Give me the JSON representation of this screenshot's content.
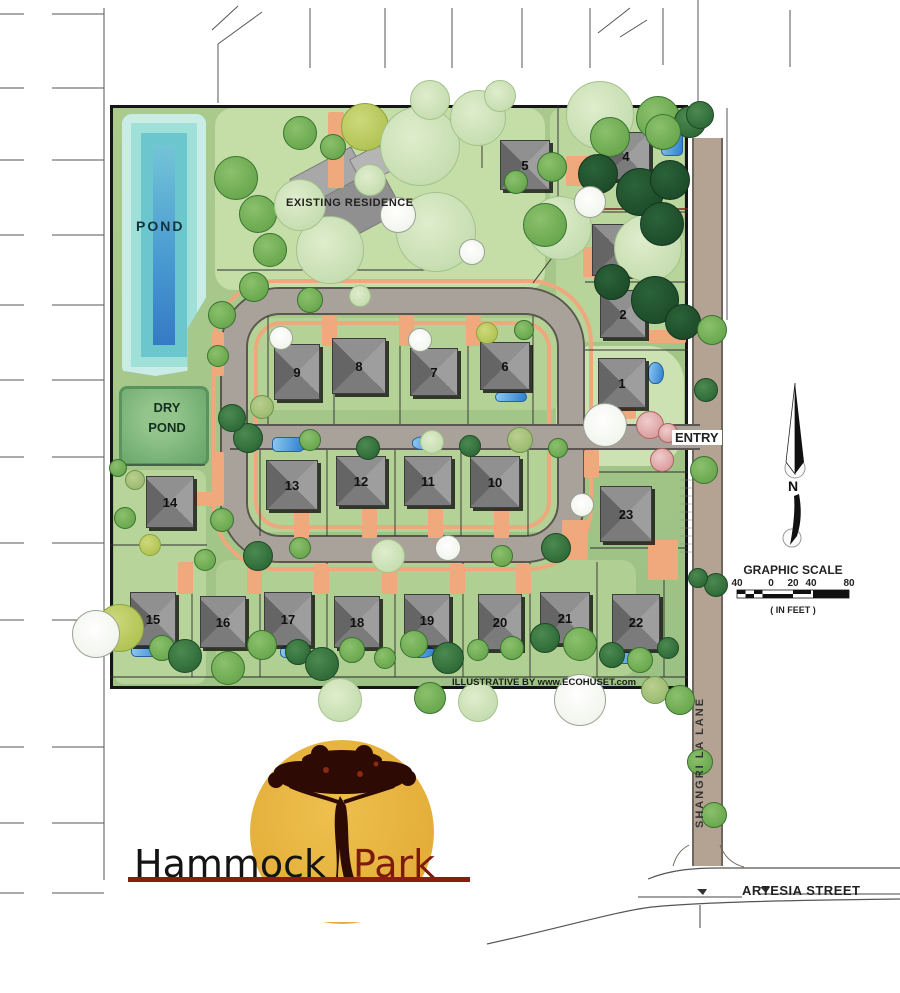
{
  "page_title": "Hammock Park Site Plan",
  "labels": {
    "pond": "POND",
    "dry_pond": "DRY POND",
    "existing_residence": "EXISTING RESIDENCE",
    "entry": "ENTRY",
    "north": "N",
    "graphic_scale": "GRAPHIC SCALE",
    "in_feet": "( IN FEET )",
    "shangri_la_lane": "SHANGRI LA LANE",
    "artesia_street": "ARTESIA STREET",
    "credit": "ILLUSTRATIVE BY www.ECOHUSET.com"
  },
  "scale_ticks": [
    "40",
    "0",
    "20",
    "40",
    "80"
  ],
  "logo": {
    "word1": "Hammock",
    "word2": "Park"
  },
  "colors": {
    "site_green": "#a6c989",
    "road_gray": "#a9a29a",
    "road_edge": "#5b5750",
    "driveway_peach": "#f0a97c",
    "lane_tan": "#b4a393",
    "pond_blue": "#2d6fbe",
    "pond_teal": "#7fd0d8",
    "dry_pond_green": "#6aa86c",
    "house_gray": "#8f8f8f",
    "logo_gold": "#e2ab35",
    "logo_red": "#8c1b10",
    "tree_palette": [
      "#6aa84f",
      "#2f6b38",
      "#1d4c2a",
      "#b2c455",
      "#c4dcae",
      "#9dbb72",
      "#f6f8f2",
      "#db9f9f"
    ]
  },
  "lots": [
    {
      "n": "1",
      "x": 598,
      "y": 358,
      "w": 48,
      "h": 50
    },
    {
      "n": "2",
      "x": 600,
      "y": 290,
      "w": 46,
      "h": 48
    },
    {
      "n": "3",
      "x": 592,
      "y": 224,
      "w": 54,
      "h": 52
    },
    {
      "n": "4",
      "x": 602,
      "y": 132,
      "w": 48,
      "h": 48
    },
    {
      "n": "5",
      "x": 500,
      "y": 140,
      "w": 50,
      "h": 50
    },
    {
      "n": "6",
      "x": 480,
      "y": 342,
      "w": 50,
      "h": 48
    },
    {
      "n": "7",
      "x": 410,
      "y": 348,
      "w": 48,
      "h": 48
    },
    {
      "n": "8",
      "x": 332,
      "y": 338,
      "w": 54,
      "h": 56
    },
    {
      "n": "9",
      "x": 274,
      "y": 344,
      "w": 46,
      "h": 56
    },
    {
      "n": "10",
      "x": 470,
      "y": 456,
      "w": 50,
      "h": 52
    },
    {
      "n": "11",
      "x": 404,
      "y": 456,
      "w": 48,
      "h": 50
    },
    {
      "n": "12",
      "x": 336,
      "y": 456,
      "w": 50,
      "h": 50
    },
    {
      "n": "13",
      "x": 266,
      "y": 460,
      "w": 52,
      "h": 50
    },
    {
      "n": "14",
      "x": 146,
      "y": 476,
      "w": 48,
      "h": 52
    },
    {
      "n": "15",
      "x": 130,
      "y": 592,
      "w": 46,
      "h": 54
    },
    {
      "n": "16",
      "x": 200,
      "y": 596,
      "w": 46,
      "h": 52
    },
    {
      "n": "17",
      "x": 264,
      "y": 592,
      "w": 48,
      "h": 54
    },
    {
      "n": "18",
      "x": 334,
      "y": 596,
      "w": 46,
      "h": 52
    },
    {
      "n": "19",
      "x": 404,
      "y": 594,
      "w": 46,
      "h": 52
    },
    {
      "n": "20",
      "x": 478,
      "y": 594,
      "w": 44,
      "h": 56
    },
    {
      "n": "21",
      "x": 540,
      "y": 592,
      "w": 50,
      "h": 52
    },
    {
      "n": "22",
      "x": 612,
      "y": 594,
      "w": 48,
      "h": 56
    },
    {
      "n": "23",
      "x": 600,
      "y": 486,
      "w": 52,
      "h": 56
    }
  ],
  "patches": [
    {
      "x": 215,
      "y": 108,
      "w": 330,
      "h": 182,
      "c": "#c5dda7",
      "r": 18
    },
    {
      "x": 550,
      "y": 108,
      "w": 134,
      "h": 118,
      "c": "#bcd79d",
      "r": 12
    },
    {
      "x": 556,
      "y": 228,
      "w": 128,
      "h": 114,
      "c": "#b7d49a",
      "r": 12
    },
    {
      "x": 556,
      "y": 346,
      "w": 128,
      "h": 120,
      "c": "#cde2b2",
      "r": 36
    },
    {
      "x": 114,
      "y": 470,
      "w": 92,
      "h": 214,
      "c": "#b7d49a",
      "r": 10
    },
    {
      "x": 216,
      "y": 560,
      "w": 420,
      "h": 116,
      "c": "#b0cf92",
      "r": 14
    },
    {
      "x": 240,
      "y": 318,
      "w": 320,
      "h": 92,
      "c": "#b4d295",
      "r": 12
    },
    {
      "x": 240,
      "y": 448,
      "w": 320,
      "h": 84,
      "c": "#b4d295",
      "r": 12
    }
  ],
  "driveways": [
    {
      "x": 322,
      "y": 316,
      "w": 15,
      "h": 30
    },
    {
      "x": 399,
      "y": 316,
      "w": 15,
      "h": 30
    },
    {
      "x": 466,
      "y": 316,
      "w": 15,
      "h": 30
    },
    {
      "x": 294,
      "y": 508,
      "w": 15,
      "h": 30
    },
    {
      "x": 362,
      "y": 508,
      "w": 15,
      "h": 30
    },
    {
      "x": 428,
      "y": 508,
      "w": 15,
      "h": 30
    },
    {
      "x": 494,
      "y": 508,
      "w": 15,
      "h": 30
    },
    {
      "x": 178,
      "y": 562,
      "w": 15,
      "h": 32
    },
    {
      "x": 247,
      "y": 562,
      "w": 15,
      "h": 32
    },
    {
      "x": 314,
      "y": 564,
      "w": 15,
      "h": 30
    },
    {
      "x": 382,
      "y": 564,
      "w": 15,
      "h": 30
    },
    {
      "x": 450,
      "y": 564,
      "w": 15,
      "h": 30
    },
    {
      "x": 516,
      "y": 564,
      "w": 15,
      "h": 30
    },
    {
      "x": 584,
      "y": 450,
      "w": 15,
      "h": 28
    },
    {
      "x": 648,
      "y": 540,
      "w": 30,
      "h": 40
    },
    {
      "x": 562,
      "y": 520,
      "w": 26,
      "h": 40
    },
    {
      "x": 610,
      "y": 405,
      "w": 26,
      "h": 14
    },
    {
      "x": 328,
      "y": 112,
      "w": 16,
      "h": 76
    },
    {
      "x": 566,
      "y": 156,
      "w": 36,
      "h": 30
    },
    {
      "x": 583,
      "y": 247,
      "w": 26,
      "h": 30
    },
    {
      "x": 648,
      "y": 330,
      "w": 38,
      "h": 13
    },
    {
      "x": 212,
      "y": 332,
      "w": 12,
      "h": 44
    },
    {
      "x": 212,
      "y": 452,
      "w": 12,
      "h": 48
    },
    {
      "x": 194,
      "y": 492,
      "w": 30,
      "h": 14
    }
  ],
  "pools": [
    {
      "x": 272,
      "y": 437,
      "w": 32,
      "h": 15,
      "k": 0
    },
    {
      "x": 412,
      "y": 436,
      "w": 30,
      "h": 14,
      "k": 1
    },
    {
      "x": 661,
      "y": 124,
      "w": 22,
      "h": 32,
      "k": 0
    },
    {
      "x": 661,
      "y": 222,
      "w": 16,
      "h": 36,
      "k": 0
    },
    {
      "x": 648,
      "y": 362,
      "w": 16,
      "h": 22,
      "k": 1
    },
    {
      "x": 495,
      "y": 392,
      "w": 32,
      "h": 10,
      "k": 0
    },
    {
      "x": 131,
      "y": 644,
      "w": 34,
      "h": 13,
      "k": 0
    },
    {
      "x": 280,
      "y": 646,
      "w": 27,
      "h": 12,
      "k": 0
    },
    {
      "x": 408,
      "y": 645,
      "w": 27,
      "h": 13,
      "k": 1
    },
    {
      "x": 614,
      "y": 652,
      "w": 30,
      "h": 12,
      "k": 0
    }
  ],
  "trees": [
    {
      "x": 236,
      "y": 178,
      "r": 22,
      "c": 0
    },
    {
      "x": 258,
      "y": 214,
      "r": 19,
      "c": 0
    },
    {
      "x": 270,
      "y": 250,
      "r": 17,
      "c": 0
    },
    {
      "x": 254,
      "y": 287,
      "r": 15,
      "c": 0
    },
    {
      "x": 300,
      "y": 133,
      "r": 17,
      "c": 0
    },
    {
      "x": 333,
      "y": 147,
      "r": 13,
      "c": 0
    },
    {
      "x": 365,
      "y": 127,
      "r": 24,
      "c": 3
    },
    {
      "x": 420,
      "y": 146,
      "r": 40,
      "c": 4
    },
    {
      "x": 478,
      "y": 118,
      "r": 28,
      "c": 4
    },
    {
      "x": 330,
      "y": 250,
      "r": 34,
      "c": 4
    },
    {
      "x": 436,
      "y": 232,
      "r": 40,
      "c": 4
    },
    {
      "x": 300,
      "y": 205,
      "r": 26,
      "c": 4
    },
    {
      "x": 560,
      "y": 228,
      "r": 32,
      "c": 4
    },
    {
      "x": 648,
      "y": 248,
      "r": 34,
      "c": 4
    },
    {
      "x": 600,
      "y": 115,
      "r": 34,
      "c": 4
    },
    {
      "x": 610,
      "y": 137,
      "r": 20,
      "c": 0
    },
    {
      "x": 658,
      "y": 118,
      "r": 22,
      "c": 0
    },
    {
      "x": 690,
      "y": 122,
      "r": 16,
      "c": 1
    },
    {
      "x": 552,
      "y": 167,
      "r": 15,
      "c": 0
    },
    {
      "x": 545,
      "y": 225,
      "r": 22,
      "c": 0
    },
    {
      "x": 598,
      "y": 174,
      "r": 20,
      "c": 2
    },
    {
      "x": 640,
      "y": 192,
      "r": 24,
      "c": 2
    },
    {
      "x": 670,
      "y": 180,
      "r": 20,
      "c": 2
    },
    {
      "x": 662,
      "y": 224,
      "r": 22,
      "c": 2
    },
    {
      "x": 612,
      "y": 282,
      "r": 18,
      "c": 2
    },
    {
      "x": 655,
      "y": 300,
      "r": 24,
      "c": 2
    },
    {
      "x": 683,
      "y": 322,
      "r": 18,
      "c": 2
    },
    {
      "x": 590,
      "y": 202,
      "r": 16,
      "c": 6
    },
    {
      "x": 398,
      "y": 215,
      "r": 18,
      "c": 6
    },
    {
      "x": 472,
      "y": 252,
      "r": 13,
      "c": 6
    },
    {
      "x": 516,
      "y": 182,
      "r": 12,
      "c": 0
    },
    {
      "x": 430,
      "y": 100,
      "r": 20,
      "c": 4
    },
    {
      "x": 500,
      "y": 96,
      "r": 16,
      "c": 4
    },
    {
      "x": 370,
      "y": 180,
      "r": 16,
      "c": 4
    },
    {
      "x": 281,
      "y": 338,
      "r": 12,
      "c": 6
    },
    {
      "x": 420,
      "y": 340,
      "r": 12,
      "c": 6
    },
    {
      "x": 487,
      "y": 333,
      "r": 11,
      "c": 3
    },
    {
      "x": 524,
      "y": 330,
      "r": 10,
      "c": 0
    },
    {
      "x": 310,
      "y": 300,
      "r": 13,
      "c": 0
    },
    {
      "x": 360,
      "y": 296,
      "r": 11,
      "c": 4
    },
    {
      "x": 222,
      "y": 315,
      "r": 14,
      "c": 0
    },
    {
      "x": 218,
      "y": 356,
      "r": 11,
      "c": 0
    },
    {
      "x": 262,
      "y": 407,
      "r": 12,
      "c": 5
    },
    {
      "x": 248,
      "y": 438,
      "r": 15,
      "c": 1
    },
    {
      "x": 310,
      "y": 440,
      "r": 11,
      "c": 0
    },
    {
      "x": 368,
      "y": 448,
      "r": 12,
      "c": 1
    },
    {
      "x": 432,
      "y": 442,
      "r": 12,
      "c": 4
    },
    {
      "x": 470,
      "y": 446,
      "r": 11,
      "c": 1
    },
    {
      "x": 520,
      "y": 440,
      "r": 13,
      "c": 5
    },
    {
      "x": 558,
      "y": 448,
      "r": 10,
      "c": 0
    },
    {
      "x": 232,
      "y": 418,
      "r": 14,
      "c": 1
    },
    {
      "x": 650,
      "y": 425,
      "r": 14,
      "c": 7
    },
    {
      "x": 668,
      "y": 433,
      "r": 10,
      "c": 7
    },
    {
      "x": 662,
      "y": 460,
      "r": 12,
      "c": 7
    },
    {
      "x": 605,
      "y": 425,
      "r": 22,
      "c": 6
    },
    {
      "x": 582,
      "y": 505,
      "r": 12,
      "c": 6
    },
    {
      "x": 258,
      "y": 556,
      "r": 15,
      "c": 1
    },
    {
      "x": 300,
      "y": 548,
      "r": 11,
      "c": 0
    },
    {
      "x": 388,
      "y": 556,
      "r": 17,
      "c": 4
    },
    {
      "x": 448,
      "y": 548,
      "r": 13,
      "c": 6
    },
    {
      "x": 502,
      "y": 556,
      "r": 11,
      "c": 0
    },
    {
      "x": 556,
      "y": 548,
      "r": 15,
      "c": 1
    },
    {
      "x": 205,
      "y": 560,
      "r": 11,
      "c": 0
    },
    {
      "x": 222,
      "y": 520,
      "r": 12,
      "c": 0
    },
    {
      "x": 120,
      "y": 628,
      "r": 24,
      "c": 3
    },
    {
      "x": 96,
      "y": 634,
      "r": 24,
      "c": 6
    },
    {
      "x": 162,
      "y": 648,
      "r": 13,
      "c": 0
    },
    {
      "x": 185,
      "y": 656,
      "r": 17,
      "c": 1
    },
    {
      "x": 228,
      "y": 668,
      "r": 17,
      "c": 0
    },
    {
      "x": 262,
      "y": 645,
      "r": 15,
      "c": 0
    },
    {
      "x": 298,
      "y": 652,
      "r": 13,
      "c": 1
    },
    {
      "x": 322,
      "y": 664,
      "r": 17,
      "c": 1
    },
    {
      "x": 352,
      "y": 650,
      "r": 13,
      "c": 0
    },
    {
      "x": 385,
      "y": 658,
      "r": 11,
      "c": 0
    },
    {
      "x": 414,
      "y": 644,
      "r": 14,
      "c": 0
    },
    {
      "x": 448,
      "y": 658,
      "r": 16,
      "c": 1
    },
    {
      "x": 478,
      "y": 650,
      "r": 11,
      "c": 0
    },
    {
      "x": 512,
      "y": 648,
      "r": 12,
      "c": 0
    },
    {
      "x": 545,
      "y": 638,
      "r": 15,
      "c": 1
    },
    {
      "x": 580,
      "y": 644,
      "r": 17,
      "c": 0
    },
    {
      "x": 612,
      "y": 655,
      "r": 13,
      "c": 1
    },
    {
      "x": 640,
      "y": 660,
      "r": 13,
      "c": 0
    },
    {
      "x": 668,
      "y": 648,
      "r": 11,
      "c": 1
    },
    {
      "x": 340,
      "y": 700,
      "r": 22,
      "c": 4
    },
    {
      "x": 430,
      "y": 698,
      "r": 16,
      "c": 0
    },
    {
      "x": 478,
      "y": 702,
      "r": 20,
      "c": 4
    },
    {
      "x": 580,
      "y": 700,
      "r": 26,
      "c": 6
    },
    {
      "x": 655,
      "y": 690,
      "r": 14,
      "c": 5
    },
    {
      "x": 700,
      "y": 115,
      "r": 14,
      "c": 1
    },
    {
      "x": 712,
      "y": 330,
      "r": 15,
      "c": 0
    },
    {
      "x": 706,
      "y": 390,
      "r": 12,
      "c": 1
    },
    {
      "x": 704,
      "y": 470,
      "r": 14,
      "c": 0
    },
    {
      "x": 716,
      "y": 585,
      "r": 12,
      "c": 1
    },
    {
      "x": 698,
      "y": 578,
      "r": 10,
      "c": 1
    },
    {
      "x": 680,
      "y": 700,
      "r": 15,
      "c": 0
    },
    {
      "x": 700,
      "y": 762,
      "r": 13,
      "c": 0
    },
    {
      "x": 714,
      "y": 815,
      "r": 13,
      "c": 0
    },
    {
      "x": 663,
      "y": 132,
      "r": 18,
      "c": 0
    },
    {
      "x": 135,
      "y": 480,
      "r": 10,
      "c": 5
    },
    {
      "x": 150,
      "y": 545,
      "r": 11,
      "c": 3
    },
    {
      "x": 125,
      "y": 518,
      "r": 11,
      "c": 0
    },
    {
      "x": 118,
      "y": 468,
      "r": 9,
      "c": 0
    }
  ]
}
